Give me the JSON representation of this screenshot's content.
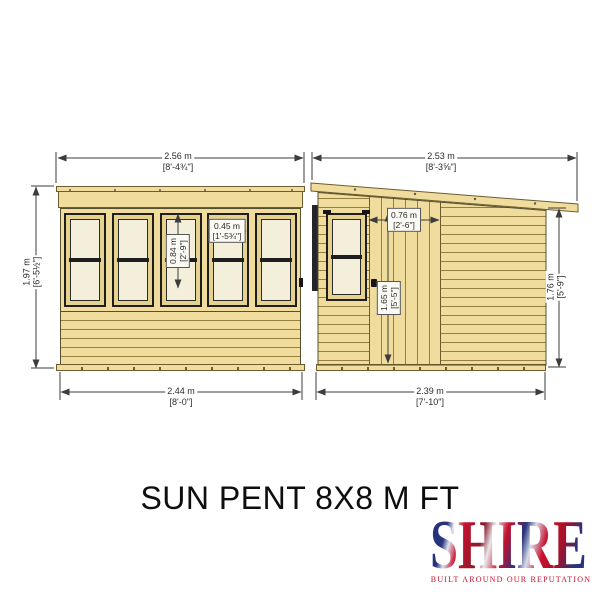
{
  "title": "SUN PENT 8X8 M FT",
  "logo": {
    "name": "SHIRE",
    "tagline": "BUILT AROUND OUR REPUTATION"
  },
  "front_view": {
    "label": "front elevation",
    "window_count": 5,
    "dims": {
      "overall_width": {
        "metric": "2.56 m",
        "imperial": "[8'-4¾\"]"
      },
      "overall_height": {
        "metric": "1.97 m",
        "imperial": "[6'-5½\"]"
      },
      "base_width": {
        "metric": "2.44 m",
        "imperial": "[8'-0\"]"
      },
      "window_height": {
        "metric": "0.84 m",
        "imperial": "[2'-9\"]"
      },
      "window_width": {
        "metric": "0.45 m",
        "imperial": "[1'-5¾\"]"
      }
    }
  },
  "side_view": {
    "label": "side elevation",
    "dims": {
      "overall_width": {
        "metric": "2.53 m",
        "imperial": "[8'-3⅝\"]"
      },
      "wall_height": {
        "metric": "1.76 m",
        "imperial": "[5'-9\"]"
      },
      "base_width": {
        "metric": "2.39 m",
        "imperial": "[7'-10\"]"
      },
      "door_width": {
        "metric": "0.76 m",
        "imperial": "[2'-6\"]"
      },
      "door_height": {
        "metric": "1.65 m",
        "imperial": "[5'-5\"]"
      }
    }
  },
  "colors": {
    "wood": "#f0dd9d",
    "wood_line": "#97803f",
    "glass": "#f4efdb",
    "frame_dark": "#1e1e1e",
    "dimension": "#3c3c3c",
    "brand_red": "#c8102e",
    "brand_blue": "#26337f"
  }
}
